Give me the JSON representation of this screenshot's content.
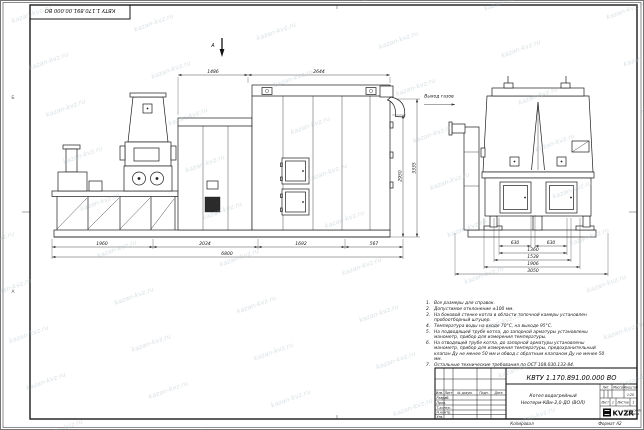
{
  "sheet": {
    "watermark_text": "kazan-kvz.ru",
    "corner_stamp": "КВТУ 1.170.891.00.000 ВО",
    "footer": {
      "copied": "Копировал",
      "format": "Формат А2"
    },
    "zone_left_top": "Б",
    "zone_left_bottom": "А"
  },
  "drawing": {
    "section_arrow_label": "А",
    "gas_outlet_label": "Выход газов",
    "left_view": {
      "dim_top_1": "1486",
      "dim_top_2": "2644",
      "dim_bottom_1": "1960",
      "dim_bottom_2": "2034",
      "dim_bottom_3": "1692",
      "dim_bottom_4": "567",
      "dim_overall_width": "6800",
      "dim_height_inner": "2950",
      "dim_height_outer": "3335"
    },
    "right_view": {
      "dim_1": "630",
      "dim_2": "630",
      "dim_3": "1360",
      "dim_4": "1538",
      "dim_5": "1906",
      "dim_overall_width": "3050"
    }
  },
  "notes": {
    "items": [
      {
        "n": "1.",
        "t": "Все размеры для справок."
      },
      {
        "n": "2.",
        "t": "Допустимое отклонение ±100 мм."
      },
      {
        "n": "3.",
        "t": "На боковой стенке котла в области топочной камеры установлен пробоотборный штуцер."
      },
      {
        "n": "4.",
        "t": "Температура воды на входе 70°С, на выходе 95°С."
      },
      {
        "n": "5.",
        "t": "На подводящей трубе котла, до запорной арматуры установлены манометр, прибор для измерения температуры."
      },
      {
        "n": "6.",
        "t": "На отводящей трубе котла, до запорной арматуры установлены манометр, прибор для измерения температуры, предохранительный клапан Ду не менее 50 мм и обвод с обратным клапаном Ду не менее 50 мм."
      },
      {
        "n": "7.",
        "t": "Остальные технические требования по ОСТ 108.030.133-84."
      }
    ]
  },
  "title_block": {
    "designation": "КВТУ 1.170.891.00.000 ВО",
    "name_line1": "Котел водогрейный",
    "name_line2": "Неотерм-КВм-2,0-ДО (ВОЛ)",
    "col_lit": "Лит.",
    "col_mass": "Масса",
    "col_scale": "Масштаб",
    "scale_value": "1:20",
    "sheet_label": "Лист",
    "sheet_value": "1",
    "sheets_label": "Листов",
    "sheets_value": "1",
    "hdr_izm": "Изм.",
    "hdr_list": "Лист",
    "hdr_doc": "№ докум.",
    "hdr_sign": "Подп.",
    "hdr_date": "Дата",
    "row_1": "Разраб.",
    "row_2": "Пров.",
    "row_3": "Т.контр.",
    "row_4": "Н.контр.",
    "row_5": "Утв.",
    "company_logo": "KVZR",
    "company_line1": "КАЗАНСКИЙ",
    "company_line2": "ЗАВОД РФ"
  }
}
